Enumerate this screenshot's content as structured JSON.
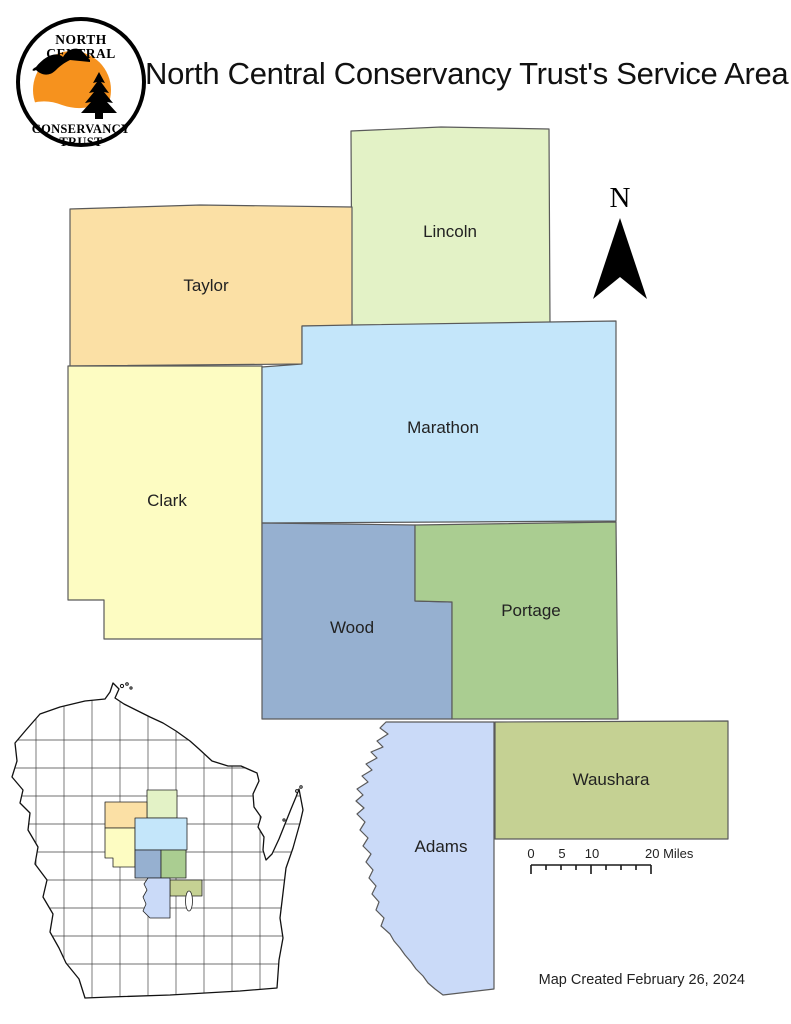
{
  "title": "North Central Conservancy Trust's Service Area",
  "logo": {
    "line1": "NORTH",
    "line2": "CENTRAL",
    "line3": "CONSERVANCY",
    "line4": "TRUST",
    "sun_color": "#F6921E"
  },
  "counties": [
    {
      "name": "Lincoln",
      "color": "#E3F2C6"
    },
    {
      "name": "Taylor",
      "color": "#FBE0A5"
    },
    {
      "name": "Clark",
      "color": "#FDFCC2"
    },
    {
      "name": "Marathon",
      "color": "#C4E6FA"
    },
    {
      "name": "Wood",
      "color": "#96B0D0"
    },
    {
      "name": "Portage",
      "color": "#AACD91"
    },
    {
      "name": "Waushara",
      "color": "#C5D193"
    },
    {
      "name": "Adams",
      "color": "#CADAF8"
    }
  ],
  "north_label": "N",
  "scale_bar": {
    "label_0": "0",
    "label_5": "5",
    "label_10": "10",
    "label_end": "20 Miles"
  },
  "credit": "Map Created February 26, 2024",
  "map_style": {
    "county_border": "#5a5a5a",
    "inset_border": "#111111"
  }
}
